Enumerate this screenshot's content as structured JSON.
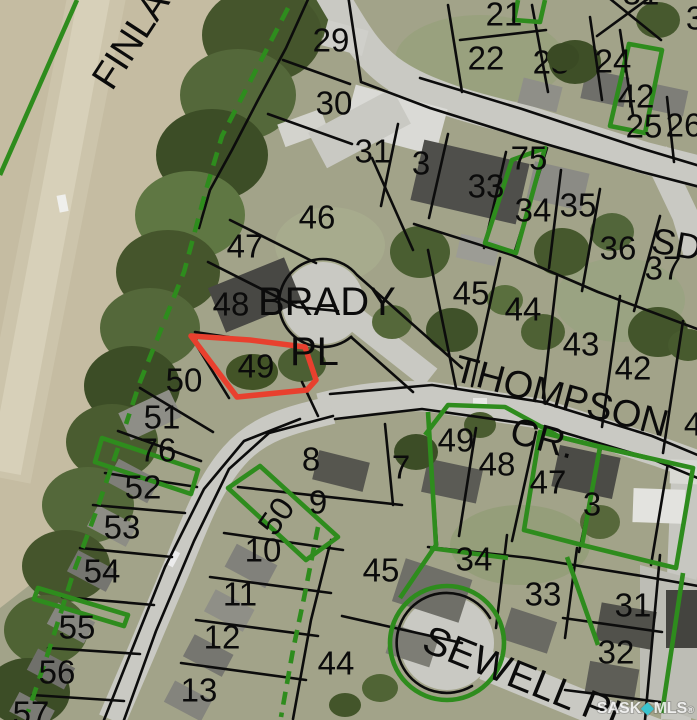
{
  "map": {
    "watermark": {
      "prefix": "SASK",
      "diamond": "◆",
      "suffix": "MLS",
      "registered": "®",
      "diamond_color": "#38c3ce"
    },
    "colors": {
      "parcel_line": "#0c0c0c",
      "highlight_green": "#2e8c1d",
      "subject_red": "#e8402e"
    },
    "subject_lot": "49",
    "street_labels": [
      {
        "text": "FINLAY",
        "x": 112,
        "y": 92,
        "rot": -57,
        "size": 38
      },
      {
        "text": "BRADY",
        "x": 258,
        "y": 315,
        "rot": 0,
        "size": 40
      },
      {
        "text": "PL",
        "x": 290,
        "y": 365,
        "rot": 0,
        "size": 40
      },
      {
        "text": "THOMPSON",
        "x": 452,
        "y": 380,
        "rot": 15,
        "size": 38
      },
      {
        "text": "CR.",
        "x": 508,
        "y": 442,
        "rot": 15,
        "size": 38
      },
      {
        "text": "SEWELL PL",
        "x": 420,
        "y": 650,
        "rot": 22,
        "size": 40
      },
      {
        "text": "SD",
        "x": 650,
        "y": 252,
        "rot": 10,
        "size": 36
      }
    ],
    "lot_labels": [
      {
        "text": "29",
        "x": 331,
        "y": 40
      },
      {
        "text": "30",
        "x": 334,
        "y": 103
      },
      {
        "text": "31",
        "x": 373,
        "y": 151
      },
      {
        "text": "3",
        "x": 421,
        "y": 163
      },
      {
        "text": "21",
        "x": 504,
        "y": 14
      },
      {
        "text": "22",
        "x": 486,
        "y": 58
      },
      {
        "text": "23",
        "x": 551,
        "y": 62
      },
      {
        "text": "24",
        "x": 613,
        "y": 61
      },
      {
        "text": "42",
        "x": 636,
        "y": 96
      },
      {
        "text": "25",
        "x": 644,
        "y": 126
      },
      {
        "text": "26",
        "x": 684,
        "y": 125
      },
      {
        "text": "31",
        "x": 641,
        "y": -7
      },
      {
        "text": "3",
        "x": 695,
        "y": 18
      },
      {
        "text": "33",
        "x": 486,
        "y": 186
      },
      {
        "text": "75",
        "x": 529,
        "y": 158
      },
      {
        "text": "34",
        "x": 533,
        "y": 210
      },
      {
        "text": "35",
        "x": 578,
        "y": 205
      },
      {
        "text": "36",
        "x": 618,
        "y": 248
      },
      {
        "text": "37",
        "x": 663,
        "y": 268
      },
      {
        "text": "46",
        "x": 317,
        "y": 217
      },
      {
        "text": "47",
        "x": 245,
        "y": 246
      },
      {
        "text": "48",
        "x": 231,
        "y": 304
      },
      {
        "text": "49",
        "x": 256,
        "y": 366
      },
      {
        "text": "50",
        "x": 184,
        "y": 380
      },
      {
        "text": "51",
        "x": 162,
        "y": 417
      },
      {
        "text": "76",
        "x": 158,
        "y": 450
      },
      {
        "text": "45",
        "x": 471,
        "y": 293
      },
      {
        "text": "44",
        "x": 523,
        "y": 309
      },
      {
        "text": "43",
        "x": 581,
        "y": 344
      },
      {
        "text": "42",
        "x": 633,
        "y": 368
      },
      {
        "text": "4",
        "x": 693,
        "y": 424
      },
      {
        "text": "52",
        "x": 143,
        "y": 487
      },
      {
        "text": "53",
        "x": 122,
        "y": 527
      },
      {
        "text": "54",
        "x": 102,
        "y": 571
      },
      {
        "text": "55",
        "x": 77,
        "y": 627
      },
      {
        "text": "56",
        "x": 57,
        "y": 672
      },
      {
        "text": "57",
        "x": 31,
        "y": 713
      },
      {
        "text": "8",
        "x": 311,
        "y": 459
      },
      {
        "text": "9",
        "x": 318,
        "y": 502
      },
      {
        "text": "7",
        "x": 401,
        "y": 467
      },
      {
        "text": "50",
        "x": 276,
        "y": 516,
        "rot": -55
      },
      {
        "text": "10",
        "x": 263,
        "y": 550
      },
      {
        "text": "11",
        "x": 240,
        "y": 594
      },
      {
        "text": "12",
        "x": 222,
        "y": 637
      },
      {
        "text": "13",
        "x": 199,
        "y": 690
      },
      {
        "text": "49",
        "x": 456,
        "y": 440
      },
      {
        "text": "48",
        "x": 497,
        "y": 464
      },
      {
        "text": "47",
        "x": 548,
        "y": 482
      },
      {
        "text": "3",
        "x": 592,
        "y": 504
      },
      {
        "text": "45",
        "x": 381,
        "y": 570
      },
      {
        "text": "44",
        "x": 336,
        "y": 663
      },
      {
        "text": "34",
        "x": 474,
        "y": 559
      },
      {
        "text": "33",
        "x": 543,
        "y": 594
      },
      {
        "text": "31",
        "x": 633,
        "y": 605
      },
      {
        "text": "32",
        "x": 616,
        "y": 652
      }
    ]
  }
}
